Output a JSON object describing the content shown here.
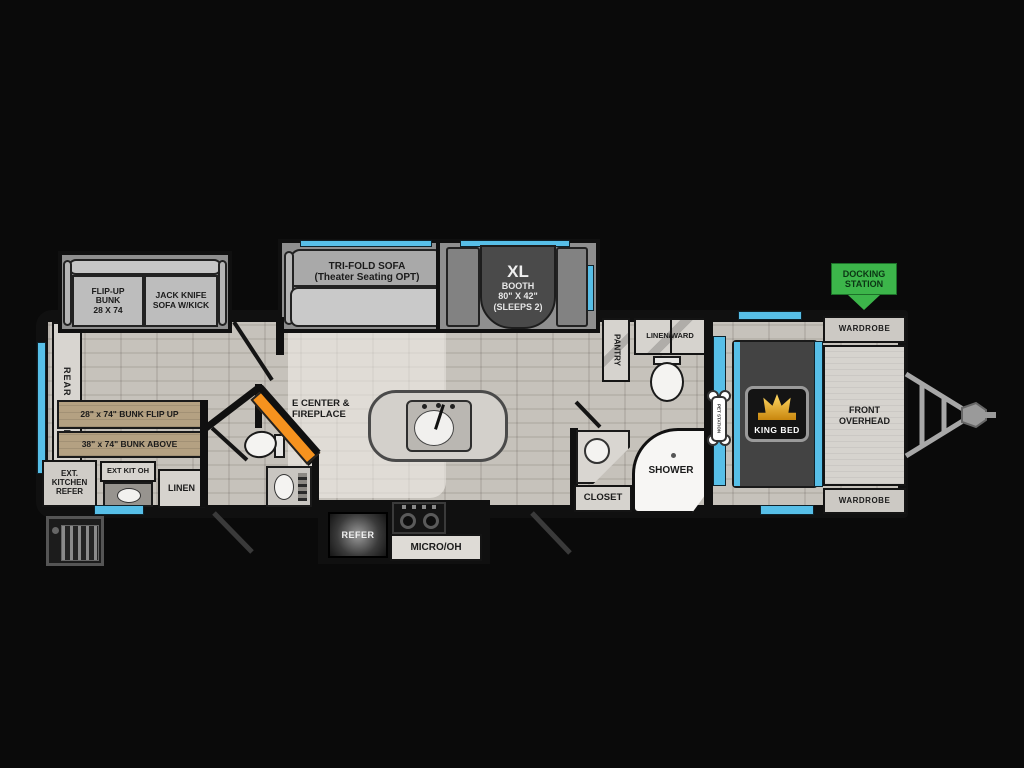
{
  "colors": {
    "background": "#0a0a0a",
    "floor": "#c6c2bb",
    "wall": "#101010",
    "accent_blue": "#57bfe8",
    "accent_orange": "#f6921e",
    "accent_green": "#3cb54a",
    "bunk_tan": "#b4a182",
    "badge_gold": "#e8a31d"
  },
  "floorplan": {
    "rear_overhead_label": "REAR OVERHEAD",
    "bunk_slide": {
      "flip_up_bunk_label": "FLIP-UP\nBUNK\n28 X 74",
      "jack_knife_label": "JACK KNIFE\nSOFA W/KICK"
    },
    "sofa_slide": {
      "label": "TRI-FOLD SOFA\n(Theater Seating OPT)"
    },
    "booth_slide": {
      "title": "XL",
      "label": "BOOTH\n80\" X 42\"\n(SLEEPS 2)"
    },
    "bunk_room": {
      "bunk_flip_up_label": "28\" x 74\" BUNK FLIP UP",
      "bunk_above_label": "38\" x 74\" BUNK ABOVE",
      "ext_kitchen_label": "EXT.\nKITCHEN\nREFER",
      "ext_kit_oh_label": "EXT KIT OH",
      "linen_label": "LINEN"
    },
    "living": {
      "ecenter_label": "E CENTER &\nFIREPLACE"
    },
    "kitchen": {
      "refer_label": "REFER",
      "micro_label": "MICRO/OH"
    },
    "bathroom": {
      "pantry_label": "PANTRY",
      "linen_ward_label": "LINEN/WARD",
      "closet_label": "CLOSET",
      "shower_label": "SHOWER"
    },
    "bedroom": {
      "king_bed_label": "KING BED",
      "pet_station_label": "PET STATION"
    },
    "front": {
      "overhead_label": "FRONT\nOVERHEAD",
      "wardrobe_top_label": "WARDROBE",
      "wardrobe_bottom_label": "WARDROBE"
    },
    "exterior": {
      "docking_station_label": "DOCKING\nSTATION"
    }
  }
}
